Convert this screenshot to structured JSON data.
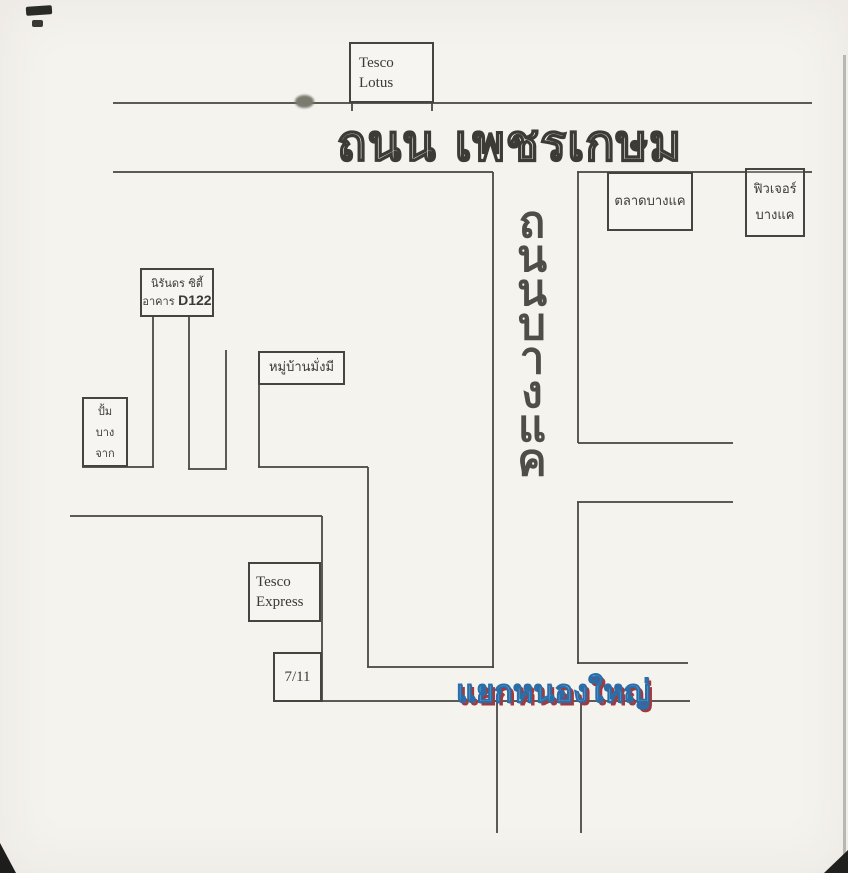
{
  "map": {
    "title_road": "ถนน เพชรเกษม",
    "roads": {
      "phetkasem": "ถนน เพชรเกษม",
      "bangkhae_full": "ถนนบางแค",
      "bangkhae_vertical_chars": [
        "ถ",
        "น",
        "น",
        "บ",
        "า",
        "ง",
        "แ",
        "ค"
      ],
      "nongyai_junction": "แยกหนองใหญ่"
    },
    "places": {
      "tesco_lotus": {
        "line1": "Tesco",
        "line2": "Lotus"
      },
      "bangkhae_market": {
        "label": "ตลาดบางแค"
      },
      "future_bangkhae": {
        "line1": "ฟิวเจอร์",
        "line2": "บางแค"
      },
      "nirandorn_city": {
        "line1": "นิรันดร ซิตี้",
        "line2_prefix": "อาคาร",
        "building_code": "D122"
      },
      "mangmee_village": {
        "label": "หมู่บ้านมั่งมี"
      },
      "bangchak_station": {
        "line1": "ปั้ม",
        "line2": "บาง",
        "line3": "จาก"
      },
      "tesco_express": {
        "line1": "Tesco",
        "line2": "Express"
      },
      "seven_eleven": {
        "label": "7/11"
      }
    },
    "colors": {
      "paper": "#f5f3ee",
      "ink": "#45443f",
      "junction_blue": "#6ec7ec",
      "junction_outline": "#2b6da8",
      "junction_shadow": "#a03a3e"
    }
  }
}
